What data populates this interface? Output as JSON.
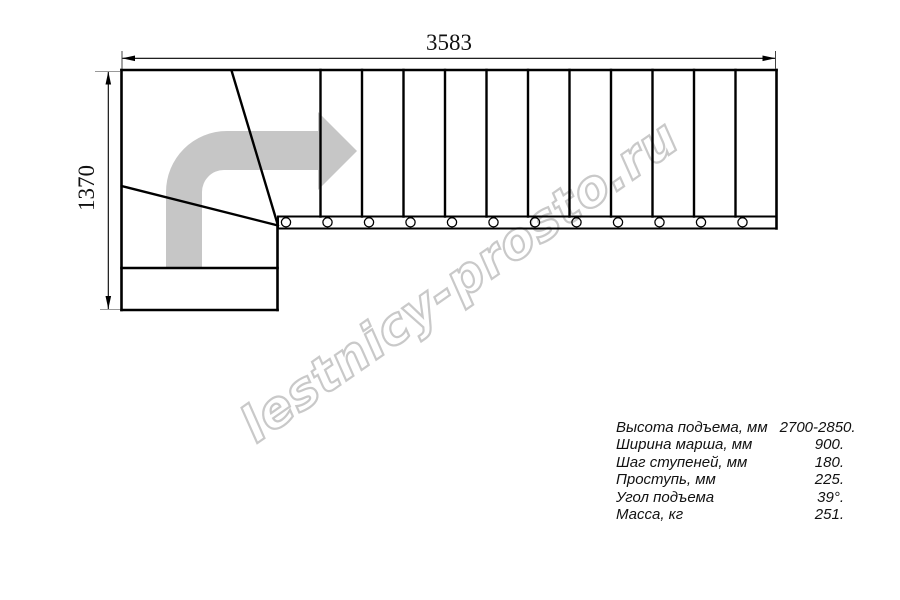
{
  "watermark": "lestnicy-prosto.ru",
  "dimensions": {
    "width_label": "3583",
    "height_label": "1370"
  },
  "specs": {
    "rows": [
      {
        "label": "Высота подъема, мм",
        "value": "2700-2850."
      },
      {
        "label": "Ширина марша, мм",
        "value": "900."
      },
      {
        "label": "Шаг ступеней, мм",
        "value": "180."
      },
      {
        "label": "Проступь, мм",
        "value": "225."
      },
      {
        "label": "Угол подъема",
        "value": "39°."
      },
      {
        "label": "Масса, кг",
        "value": "251."
      }
    ]
  },
  "drawing": {
    "type": "staircase-plan-top-view",
    "straight_flight_treads": 12,
    "stringer_circles": 12,
    "winder_turn": "90-degree left-to-right turn at bottom landing"
  },
  "colors": {
    "line": "#000000",
    "arrow": "#c6c6c6",
    "watermark": "#c9c9c9",
    "extension": "#999999"
  }
}
